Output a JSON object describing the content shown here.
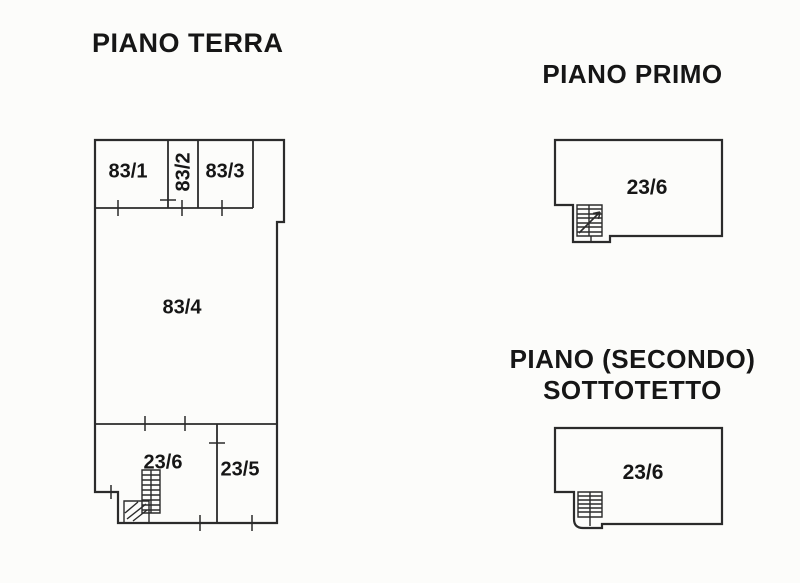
{
  "colors": {
    "background": "#fcfcfa",
    "line": "#2b2b2b",
    "text": "#161616"
  },
  "floors": [
    {
      "id": "piano-terra",
      "title": "PIANO TERRA",
      "rooms": [
        {
          "id": "83-1",
          "label": "83/1"
        },
        {
          "id": "83-2",
          "label": "83/2"
        },
        {
          "id": "83-3",
          "label": "83/3"
        },
        {
          "id": "83-4",
          "label": "83/4"
        },
        {
          "id": "23-6",
          "label": "23/6"
        },
        {
          "id": "23-5",
          "label": "23/5"
        }
      ]
    },
    {
      "id": "piano-primo",
      "title": "PIANO PRIMO",
      "rooms": [
        {
          "id": "23-6",
          "label": "23/6"
        }
      ]
    },
    {
      "id": "piano-secondo-sottotetto",
      "title_line1": "PIANO (SECONDO)",
      "title_line2": "SOTTOTETTO",
      "rooms": [
        {
          "id": "23-6",
          "label": "23/6"
        }
      ]
    }
  ]
}
